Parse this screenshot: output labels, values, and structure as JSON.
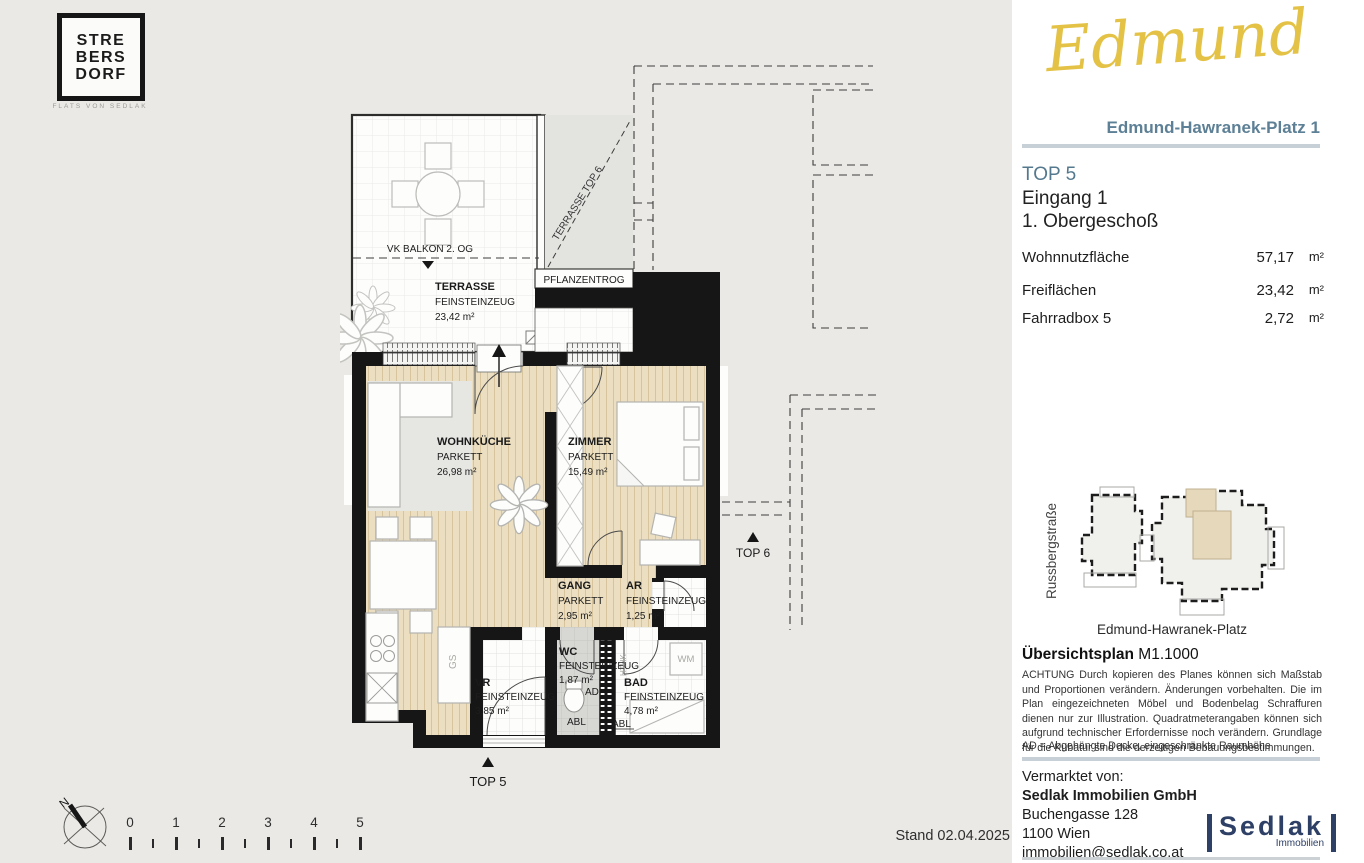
{
  "brand": {
    "line1": "STRE",
    "line2": "BERS",
    "line3": "DORF",
    "sub": "FLATS VON SEDLAK"
  },
  "project": {
    "name": "Edmund",
    "address": "Edmund-Hawranek-Platz 1"
  },
  "unit": {
    "top": "TOP 5",
    "entrance": "Eingang 1",
    "floor": "1. Obergeschoß",
    "areas": [
      {
        "label": "Wohnnutzfläche",
        "value": "57,17",
        "unit": "m²"
      },
      {
        "label": "Freiflächen",
        "value": "23,42",
        "unit": "m²"
      },
      {
        "label": "Fahrradbox 5",
        "value": "2,72",
        "unit": "m²"
      }
    ]
  },
  "plan": {
    "vk_balkon": "VK BALKON 2. OG",
    "terrace": {
      "name": "TERRASSE",
      "floor": "FEINSTEINZEUG",
      "area": "23,42 m²"
    },
    "pflanzentrog": "PFLANZENTROG",
    "terrasse_top6": "TERRASSE TOP 6",
    "wohnkueche": {
      "name": "WOHNKÜCHE",
      "floor": "PARKETT",
      "area": "26,98 m²"
    },
    "zimmer": {
      "name": "ZIMMER",
      "floor": "PARKETT",
      "area": "15,49 m²"
    },
    "gang": {
      "name": "GANG",
      "floor": "PARKETT",
      "area": "2,95 m²"
    },
    "ar": {
      "name": "AR",
      "floor": "FEINSTEINZEUG",
      "area": "1,25 m²"
    },
    "wc": {
      "name": "WC",
      "floor": "FEINSTEINZEUG",
      "area": "1,87 m²",
      "ad": "AD",
      "abl": "ABL"
    },
    "bad": {
      "name": "BAD",
      "floor": "FEINSTEINZEUG",
      "area": "4,78 m²",
      "abl": "ABL"
    },
    "vr": {
      "name": "VR",
      "floor": "FEINSTEINZEUG",
      "area": "3,85 m²"
    },
    "gs": "GS",
    "wm": "WM",
    "hthk": "HTHK",
    "top6": "TOP 6",
    "top5": "TOP 5"
  },
  "sitemap": {
    "street_left": "Russbergstraße",
    "street_bottom": "Edmund-Hawranek-Platz"
  },
  "overview": {
    "title": "Übersichtsplan",
    "scale": "M1.1000",
    "disclaimer": "ACHTUNG Durch kopieren des Planes können sich Maßstab und Proportionen verändern. Änderungen vorbehalten. Die im Plan eingezeichneten Möbel und Bodenbelag Schraffuren dienen nur zur Illustration. Quadratmeterangaben können sich aufgrund technischer Erfordernisse noch verändern. Grundlage für die Kubatur sind die derzeitigen Bebauungsbestimmungen.",
    "ad_note": "AD = Abgehängte Decke, eingeschränkte Raumhöhe"
  },
  "marketer": {
    "intro": "Vermarktet von:",
    "company": "Sedlak Immobilien GmbH",
    "street": "Buchengasse 128",
    "city": "1100 Wien",
    "email": "immobilien@sedlak.co.at",
    "logo_text": "Sedlak",
    "logo_sub": "Immobilien"
  },
  "footer": {
    "stand": "Stand 02.04.2025"
  },
  "compass": {
    "north": "N"
  },
  "scalebar": {
    "labels": [
      "0",
      "1",
      "2",
      "3",
      "4",
      "5"
    ]
  },
  "colors": {
    "accent_gold": "#e3c245",
    "accent_blue": "#5d8096",
    "navy": "#2e4066",
    "parquet": "#ebdec1"
  }
}
